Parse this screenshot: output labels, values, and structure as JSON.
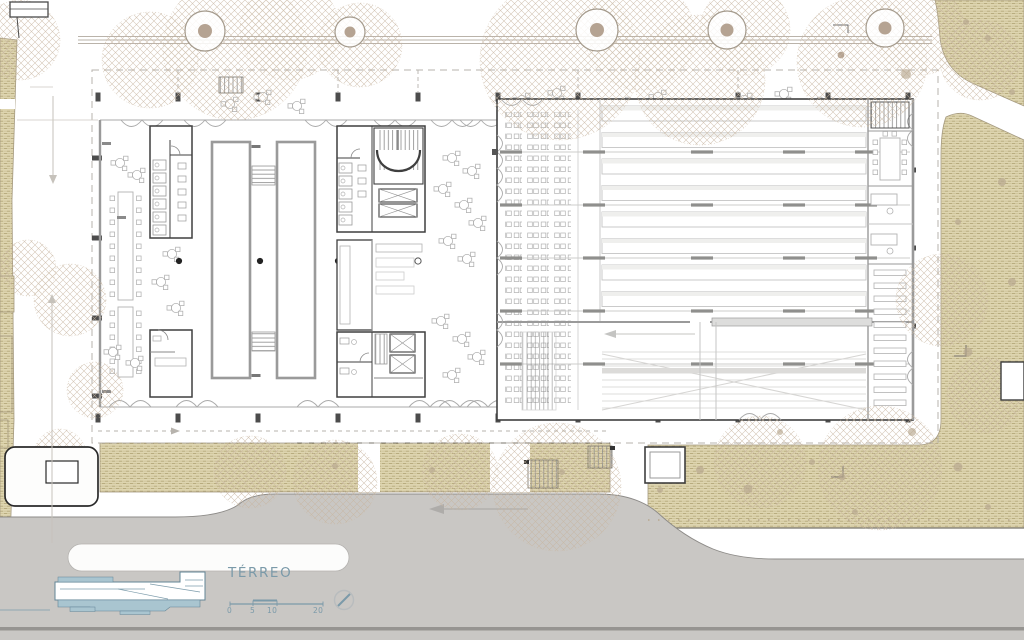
{
  "legend": {
    "floor_label": "TÉRREO",
    "scale_bar": {
      "labels": [
        "0",
        "5",
        "10",
        "20"
      ]
    },
    "icons": {
      "north": "north-arrow-icon",
      "section_key": "building-section-key"
    }
  },
  "palette": {
    "lawn_fill": "#ded5b0",
    "lawn_weave": "#b7aa7c",
    "road": "#c9c7c4",
    "road_edge": "#8d8b88",
    "wall_dark": "#3f3f3f",
    "wall_gray": "#9a9a9a",
    "furniture": "#b2b2b2",
    "tree_canopy": "#c8b6a1",
    "tree_trunk": "#b5a392",
    "accent_blue": "#7b9aa9",
    "section_fill": "#a9c5d0"
  }
}
